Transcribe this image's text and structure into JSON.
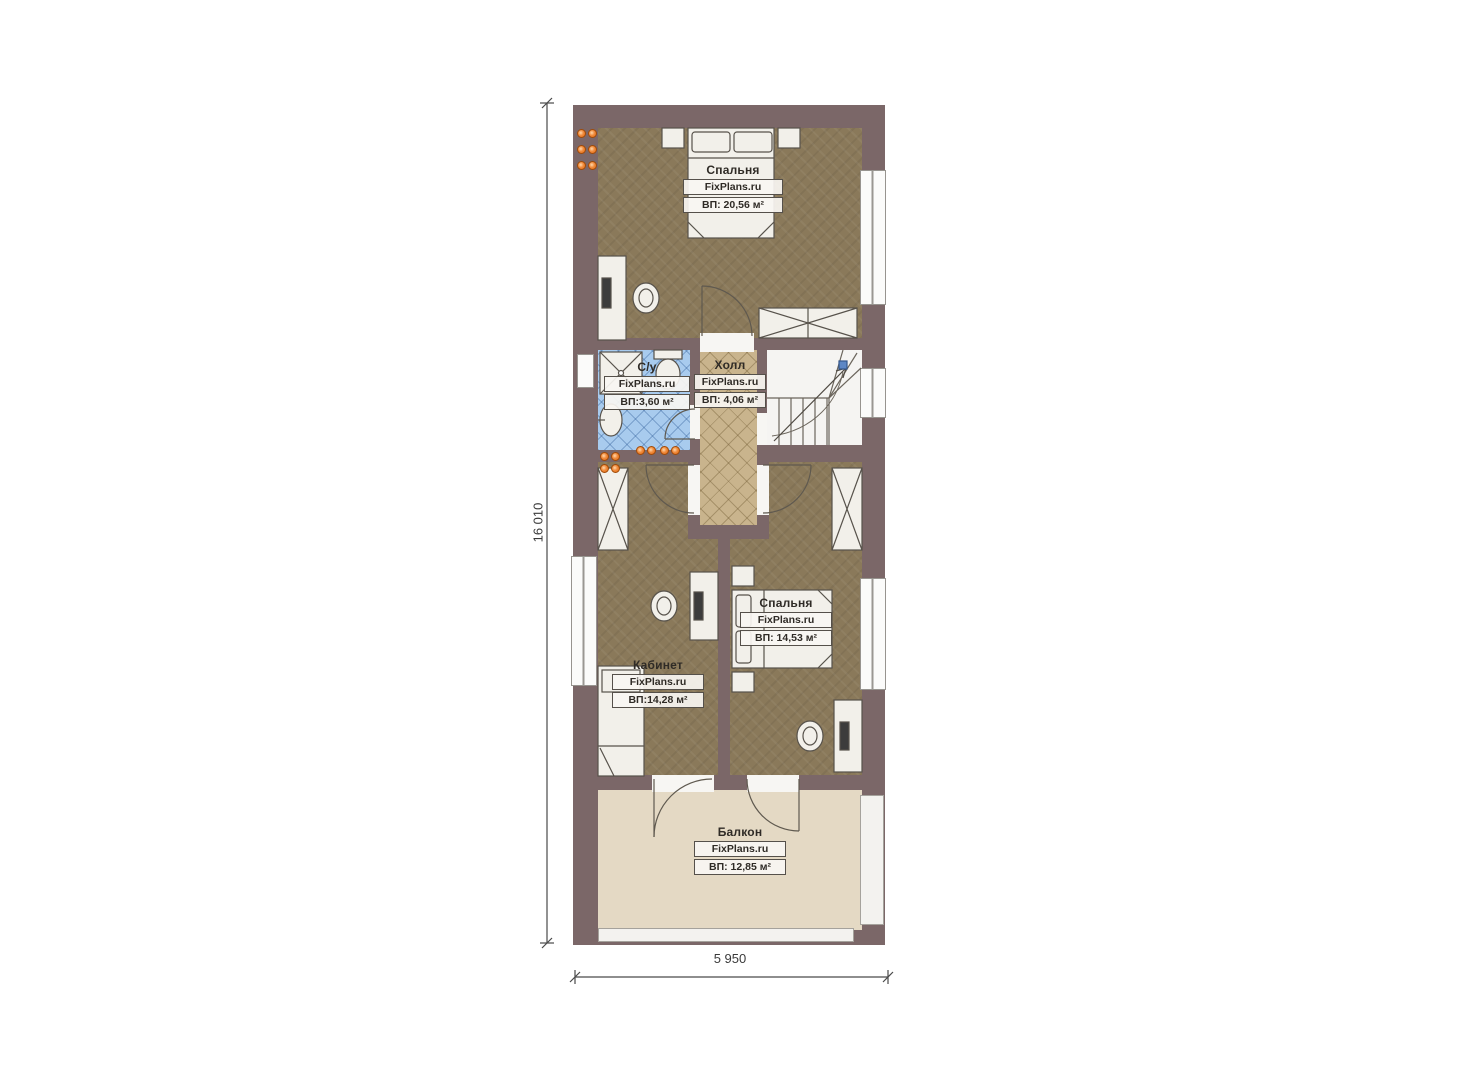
{
  "plan": {
    "brand": "FixPlans.ru",
    "dimensions": {
      "height_label": "16 010",
      "width_label": "5 950"
    },
    "rooms": [
      {
        "key": "bedroom-top",
        "name": "Спальня",
        "brand": "FixPlans.ru",
        "area": "ВП: 20,56 м²"
      },
      {
        "key": "bathroom",
        "name": "С/у",
        "brand": "FixPlans.ru",
        "area": "ВП:3,60 м²"
      },
      {
        "key": "hall",
        "name": "Холл",
        "brand": "FixPlans.ru",
        "area": "ВП: 4,06 м²"
      },
      {
        "key": "bedroom-lower",
        "name": "Спальня",
        "brand": "FixPlans.ru",
        "area": "ВП: 14,53 м²"
      },
      {
        "key": "office",
        "name": "Кабинет",
        "brand": "FixPlans.ru",
        "area": "ВП:14,28 м²"
      },
      {
        "key": "balcony",
        "name": "Балкон",
        "brand": "FixPlans.ru",
        "area": "ВП: 12,85 м²"
      }
    ],
    "colors": {
      "wall": "#7b6768",
      "room_floor": "#8a795a",
      "hall_tile": "#c9b48d",
      "bath_tile": "#a8cbee",
      "balcony_floor": "#e4d9c4",
      "radiator": "#ef7b28",
      "stair_marker": "#5d87c5"
    }
  }
}
